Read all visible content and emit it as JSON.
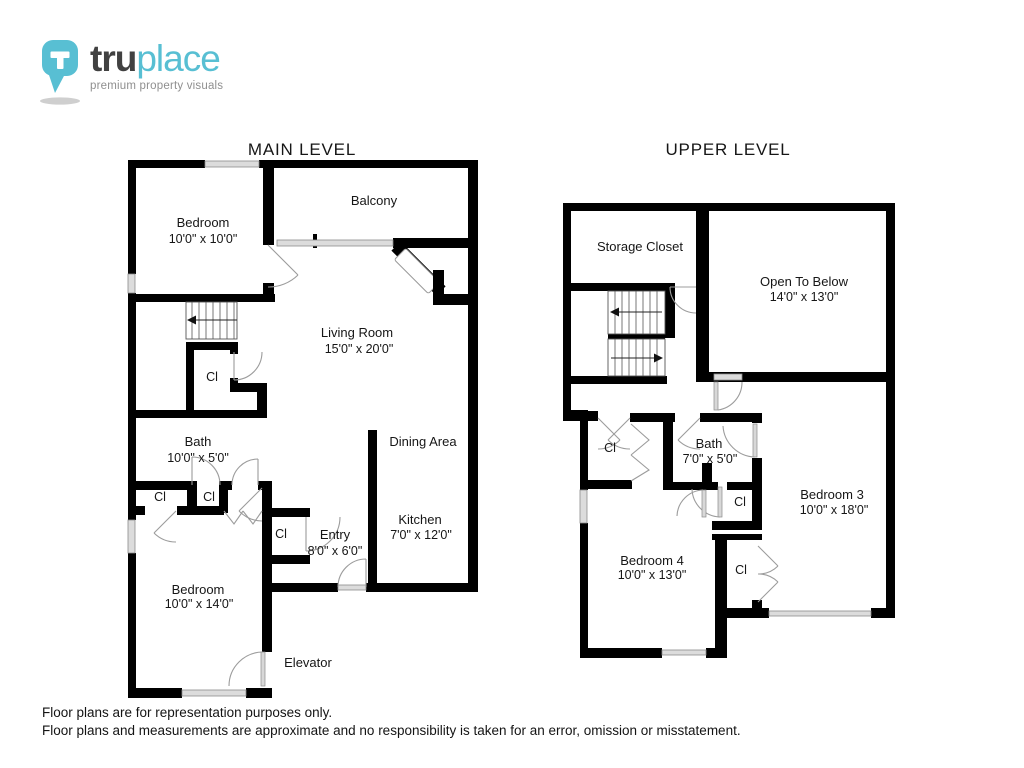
{
  "logo": {
    "brand_bold": "tru",
    "brand_light": "place",
    "tagline": "premium property visuals",
    "accent_color": "#58bfd3",
    "dark_color": "#414141"
  },
  "main_plan": {
    "title": "MAIN LEVEL",
    "bedroom1": {
      "name": "Bedroom",
      "dims": "10'0\" x 10'0\""
    },
    "balcony": {
      "name": "Balcony"
    },
    "living": {
      "name": "Living Room",
      "dims": "15'0\" x 20'0\""
    },
    "closet_hall": {
      "name": "Cl"
    },
    "bath": {
      "name": "Bath",
      "dims": "10'0\" x 5'0\""
    },
    "closet_left": {
      "name": "Cl"
    },
    "closet_mid": {
      "name": "Cl"
    },
    "closet_entry": {
      "name": "Cl"
    },
    "entry": {
      "name": "Entry",
      "dims": "8'0\" x 6'0\""
    },
    "dining": {
      "name": "Dining Area"
    },
    "kitchen": {
      "name": "Kitchen",
      "dims": "7'0\" x 12'0\""
    },
    "bedroom2": {
      "name": "Bedroom",
      "dims": "10'0\" x 14'0\""
    },
    "elevator": {
      "name": "Elevator"
    }
  },
  "upper_plan": {
    "title": "UPPER LEVEL",
    "storage": {
      "name": "Storage Closet"
    },
    "open_below": {
      "name": "Open To Below",
      "dims": "14'0\" x 13'0\""
    },
    "bath": {
      "name": "Bath",
      "dims": "7'0\" x 5'0\""
    },
    "closet_a": {
      "name": "Cl"
    },
    "closet_b": {
      "name": "Cl"
    },
    "closet_c": {
      "name": "Cl"
    },
    "bedroom3": {
      "name": "Bedroom 3",
      "dims": "10'0\" x 18'0\""
    },
    "bedroom4": {
      "name": "Bedroom 4",
      "dims": "10'0\" x 13'0\""
    }
  },
  "disclaimer": {
    "line1": "Floor plans are for representation purposes only.",
    "line2": "Floor plans and measurements are approximate and no responsibility is taken for an error, omission or misstatement."
  }
}
